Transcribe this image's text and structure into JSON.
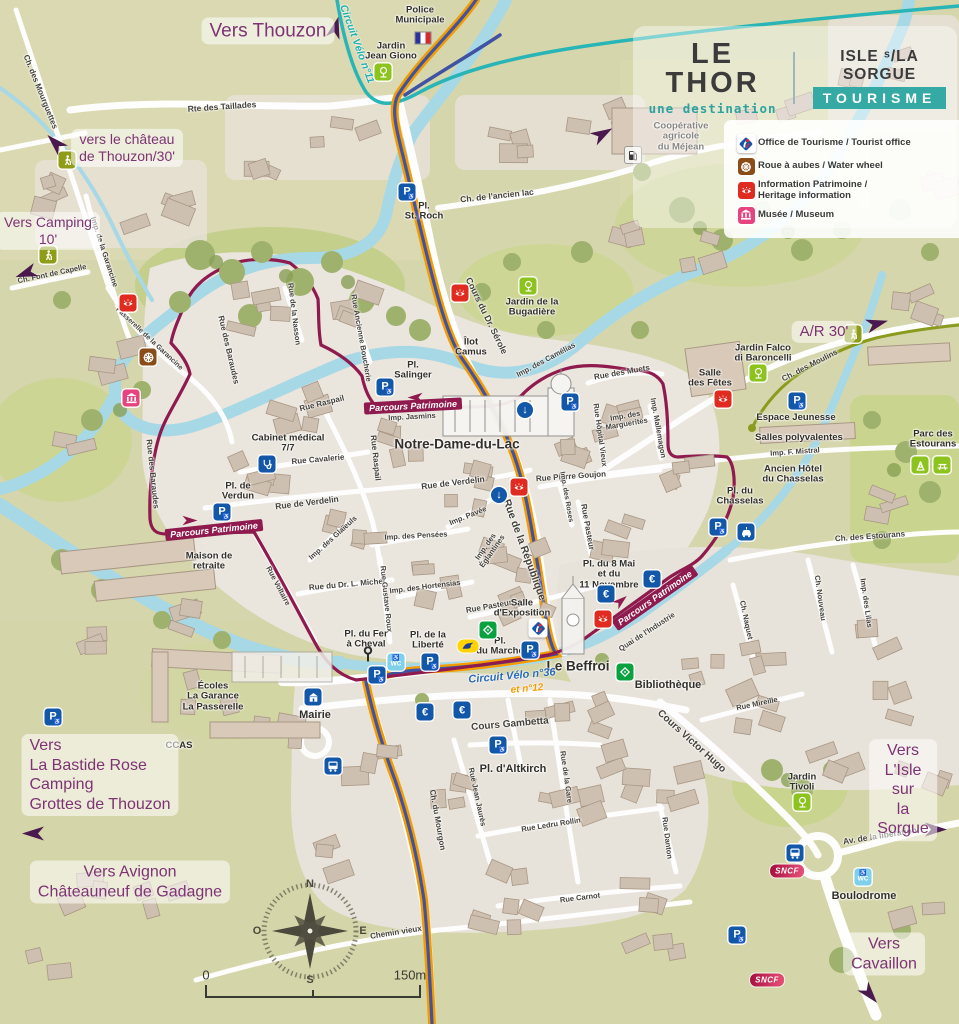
{
  "branding": {
    "title": "LE THOR",
    "subtitle": "une destination",
    "org_top": "ISLE ˢ/LA SORGUE",
    "org_bottom": "TOURISME"
  },
  "legend": {
    "items": [
      {
        "icon": "ot",
        "label": "Office de Tourisme / Tourist office"
      },
      {
        "icon": "wheel",
        "label": "Roue à aubes / Water wheel"
      },
      {
        "icon": "eye",
        "label": "Information Patrimoine /\nHeritage information"
      },
      {
        "icon": "museum",
        "label": "Musée / Museum"
      }
    ]
  },
  "compass": {
    "n": "N",
    "s": "S",
    "e": "E",
    "o": "O"
  },
  "scale": {
    "start": "0",
    "end": "150m"
  },
  "directions": [
    {
      "t": "Vers Thouzon",
      "x": 268,
      "y": 31,
      "s": 19
    },
    {
      "t": "vers le château\nde Thouzon/30'",
      "x": 127,
      "y": 148,
      "s": 14
    },
    {
      "t": "Vers Camping\n10'",
      "x": 48,
      "y": 231,
      "s": 14
    },
    {
      "t": "A/R 30'",
      "x": 824,
      "y": 332,
      "s": 15
    },
    {
      "t": "Vers\nLa Bastide Rose\nCamping\nGrottes de Thouzon",
      "x": 100,
      "y": 775,
      "s": 16,
      "align": "left"
    },
    {
      "t": "Vers Avignon\nChâteauneuf de Gadagne",
      "x": 130,
      "y": 882,
      "s": 16
    },
    {
      "t": "Vers\nL'Isle sur\nla Sorgue",
      "x": 903,
      "y": 790,
      "s": 16
    },
    {
      "t": "Vers Cavaillon",
      "x": 884,
      "y": 954,
      "s": 16
    }
  ],
  "route_labels": [
    {
      "t": "Circuit Vélo n°11",
      "x": 357,
      "y": 44,
      "r": 70,
      "c": "#1fb0b0",
      "s": 10.5
    },
    {
      "t": "Circuit Vélo n°36",
      "x": 512,
      "y": 676,
      "r": -5,
      "c": "#2a6bb5",
      "s": 11
    },
    {
      "t": "et n°12",
      "x": 527,
      "y": 689,
      "r": -5,
      "c": "#f39c00",
      "s": 10
    },
    {
      "t": "Parcours Patrimoine",
      "x": 214,
      "y": 530,
      "r": -6,
      "c": "#8f1a4d",
      "band": true
    },
    {
      "t": "Parcours Patrimoine",
      "x": 413,
      "y": 406,
      "r": -3,
      "c": "#8f1a4d",
      "band": true
    },
    {
      "t": "Parcours Patrimoine",
      "x": 655,
      "y": 598,
      "r": -35,
      "c": "#8f1a4d",
      "band": true
    }
  ],
  "places": [
    {
      "t": "Police\nMunicipale",
      "x": 420,
      "y": 16
    },
    {
      "t": "Jardin\nJean Giono",
      "x": 391,
      "y": 52
    },
    {
      "t": "Coopérative\nagricole\ndu Méjean",
      "x": 681,
      "y": 137
    },
    {
      "t": "Pl.\nSt. Roch",
      "x": 424,
      "y": 212
    },
    {
      "t": "Jardin de la\nBugadière",
      "x": 532,
      "y": 308
    },
    {
      "t": "Îlot\nCamus",
      "x": 471,
      "y": 348
    },
    {
      "t": "Pl.\nSalinger",
      "x": 413,
      "y": 371
    },
    {
      "t": "Notre-Dame-du-Lac",
      "x": 457,
      "y": 445,
      "s": 13.5
    },
    {
      "t": "Cabinet médical\n7/7",
      "x": 288,
      "y": 444
    },
    {
      "t": "Pl. de\nVerdun",
      "x": 238,
      "y": 492
    },
    {
      "t": "Maison de\nretraite",
      "x": 209,
      "y": 562
    },
    {
      "t": "Salle\ndes Fêtes",
      "x": 710,
      "y": 379
    },
    {
      "t": "Jardin Falco\ndi Baroncelli",
      "x": 763,
      "y": 354
    },
    {
      "t": "Espace Jeunesse",
      "x": 796,
      "y": 418
    },
    {
      "t": "Salles polyvalentes",
      "x": 799,
      "y": 438
    },
    {
      "t": "Ancien Hôtel\ndu Chasselas",
      "x": 793,
      "y": 475
    },
    {
      "t": "Parc des\nEstourans",
      "x": 933,
      "y": 440
    },
    {
      "t": "Pl. du\nChasselas",
      "x": 740,
      "y": 497
    },
    {
      "t": "Pl. du 8 Mai\net du\n11 Novembre",
      "x": 609,
      "y": 575
    },
    {
      "t": "Salle\nd'Exposition",
      "x": 522,
      "y": 609
    },
    {
      "t": "Pl. du Fer\nà Cheval",
      "x": 366,
      "y": 640
    },
    {
      "t": "Pl. de la\nLiberté",
      "x": 428,
      "y": 641
    },
    {
      "t": "Pl.\ndu Marché",
      "x": 500,
      "y": 647
    },
    {
      "t": "Le Beffroi",
      "x": 578,
      "y": 667,
      "s": 13.5
    },
    {
      "t": "Mairie",
      "x": 315,
      "y": 715,
      "s": 11
    },
    {
      "t": "Écoles\nLa Garance\nLa Passerelle",
      "x": 213,
      "y": 697
    },
    {
      "t": "CCAS",
      "x": 179,
      "y": 746
    },
    {
      "t": "Pl. d'Altkirch",
      "x": 513,
      "y": 769,
      "s": 11
    },
    {
      "t": "Bibliothèque",
      "x": 668,
      "y": 685,
      "s": 11
    },
    {
      "t": "Jardin\nTivoli",
      "x": 802,
      "y": 783
    },
    {
      "t": "Boulodrome",
      "x": 864,
      "y": 896,
      "s": 11
    }
  ],
  "streets": [
    {
      "t": "Ch. des Mourguettes",
      "x": 40,
      "y": 92,
      "r": 68,
      "s": 8
    },
    {
      "t": "Rte des Taillades",
      "x": 222,
      "y": 107,
      "r": -4,
      "s": 8.5
    },
    {
      "t": "Ch. de l'ancien lac",
      "x": 497,
      "y": 196,
      "r": -6,
      "s": 8.5
    },
    {
      "t": "Cours du Dr. Sérole",
      "x": 486,
      "y": 316,
      "r": 64,
      "s": 9
    },
    {
      "t": "Imp. de la Garancine",
      "x": 104,
      "y": 252,
      "r": 72,
      "s": 7.5
    },
    {
      "t": "Ch. Font de Capelle",
      "x": 52,
      "y": 274,
      "r": -12,
      "s": 7.5
    },
    {
      "t": "Passerelle de la Garancine",
      "x": 149,
      "y": 339,
      "r": 43,
      "s": 7
    },
    {
      "t": "Rue des Baraudes",
      "x": 228,
      "y": 350,
      "r": 77,
      "s": 8
    },
    {
      "t": "Rue des Baraudes",
      "x": 152,
      "y": 474,
      "r": 84,
      "s": 8
    },
    {
      "t": "Rue de la Nasson",
      "x": 294,
      "y": 314,
      "r": 83,
      "s": 7.5
    },
    {
      "t": "Rue Ancienne Boucherie",
      "x": 361,
      "y": 338,
      "r": 80,
      "s": 7.5
    },
    {
      "t": "Rue Raspail",
      "x": 322,
      "y": 404,
      "r": -14,
      "s": 8
    },
    {
      "t": "Rue Raspail",
      "x": 375,
      "y": 458,
      "r": 84,
      "s": 8
    },
    {
      "t": "Rue Cavalerie",
      "x": 318,
      "y": 460,
      "r": -5,
      "s": 8
    },
    {
      "t": "Imp. Jasmins",
      "x": 412,
      "y": 417,
      "r": -3,
      "s": 7.5
    },
    {
      "t": "Rue de Verdelin",
      "x": 307,
      "y": 503,
      "r": -7,
      "s": 8.5
    },
    {
      "t": "Rue de Verdelin",
      "x": 453,
      "y": 483,
      "r": -7,
      "s": 8.5
    },
    {
      "t": "Imp. des Glaïeuls",
      "x": 333,
      "y": 538,
      "r": -42,
      "s": 7.5
    },
    {
      "t": "Imp. Pavée",
      "x": 468,
      "y": 516,
      "r": -22,
      "s": 7.5
    },
    {
      "t": "Imp. des Pensées",
      "x": 416,
      "y": 536,
      "r": -3,
      "s": 7.5
    },
    {
      "t": "Imp. des\nÉglantines",
      "x": 489,
      "y": 549,
      "r": -55,
      "s": 7.5
    },
    {
      "t": "Imp. des Hortensias",
      "x": 425,
      "y": 587,
      "r": -7,
      "s": 7.5
    },
    {
      "t": "Rue du Dr. L. Michel",
      "x": 347,
      "y": 585,
      "r": -5,
      "s": 8
    },
    {
      "t": "Rue Gustave Roux",
      "x": 386,
      "y": 599,
      "r": 84,
      "s": 7.5
    },
    {
      "t": "Rue Voltaire",
      "x": 278,
      "y": 586,
      "r": 62,
      "s": 7.5
    },
    {
      "t": "Rue de la République",
      "x": 524,
      "y": 550,
      "r": 70,
      "s": 10.5
    },
    {
      "t": "Rue Pasteur",
      "x": 587,
      "y": 527,
      "r": 80,
      "s": 8
    },
    {
      "t": "Rue Pasteur",
      "x": 489,
      "y": 607,
      "r": -10,
      "s": 8
    },
    {
      "t": "Rue Pierre Goujon",
      "x": 571,
      "y": 477,
      "r": -4,
      "s": 8
    },
    {
      "t": "Imp. des Roses",
      "x": 566,
      "y": 497,
      "r": 80,
      "s": 7
    },
    {
      "t": "Rue Hôpital Vieux",
      "x": 600,
      "y": 435,
      "r": 82,
      "s": 7.5
    },
    {
      "t": "Imp. des\nMarguerites",
      "x": 626,
      "y": 420,
      "r": -10,
      "s": 7.5
    },
    {
      "t": "Rue des Muets",
      "x": 622,
      "y": 373,
      "r": -10,
      "s": 8
    },
    {
      "t": "Imp. Mallemagon",
      "x": 658,
      "y": 428,
      "r": 80,
      "s": 7.5
    },
    {
      "t": "Imp. des Camélias",
      "x": 546,
      "y": 360,
      "r": -28,
      "s": 7.5
    },
    {
      "t": "Ch. des Moulins",
      "x": 810,
      "y": 366,
      "r": -27,
      "s": 8
    },
    {
      "t": "Imp. F. Mistral",
      "x": 795,
      "y": 452,
      "r": -4,
      "s": 7.5
    },
    {
      "t": "Ch. des Estourans",
      "x": 870,
      "y": 537,
      "r": -4,
      "s": 8
    },
    {
      "t": "Ch. Naquet",
      "x": 746,
      "y": 620,
      "r": 78,
      "s": 7.5
    },
    {
      "t": "Ch. Nouveau",
      "x": 820,
      "y": 598,
      "r": 82,
      "s": 7.5
    },
    {
      "t": "Imp. des Lilas",
      "x": 866,
      "y": 603,
      "r": 82,
      "s": 7.5
    },
    {
      "t": "Quai de l'Industrie",
      "x": 647,
      "y": 632,
      "r": -33,
      "s": 7.5
    },
    {
      "t": "Rue Mireille",
      "x": 757,
      "y": 704,
      "r": -12,
      "s": 7.5
    },
    {
      "t": "Cours Victor Hugo",
      "x": 691,
      "y": 742,
      "r": 42,
      "s": 10
    },
    {
      "t": "Cours Gambetta",
      "x": 510,
      "y": 725,
      "r": -5,
      "s": 10
    },
    {
      "t": "Rue Jean Jaurès",
      "x": 477,
      "y": 797,
      "r": 78,
      "s": 7.5
    },
    {
      "t": "Rue de la Gare",
      "x": 566,
      "y": 777,
      "r": 82,
      "s": 7.5
    },
    {
      "t": "Rue Ledru Rollin",
      "x": 551,
      "y": 825,
      "r": -9,
      "s": 7.5
    },
    {
      "t": "Rue Carnot",
      "x": 580,
      "y": 898,
      "r": -7,
      "s": 7.5
    },
    {
      "t": "Rue Danton",
      "x": 667,
      "y": 838,
      "r": 83,
      "s": 7.5
    },
    {
      "t": "Ch. du Mourgon",
      "x": 437,
      "y": 820,
      "r": 80,
      "s": 8
    },
    {
      "t": "Chemin vieux",
      "x": 396,
      "y": 933,
      "r": -9,
      "s": 8
    },
    {
      "t": "Av. de la libération",
      "x": 880,
      "y": 836,
      "r": -9,
      "s": 8.5
    }
  ],
  "markers": [
    {
      "k": "parking",
      "x": 407,
      "y": 192
    },
    {
      "k": "parking",
      "x": 385,
      "y": 387
    },
    {
      "k": "parking",
      "x": 570,
      "y": 402
    },
    {
      "k": "parking",
      "x": 222,
      "y": 512
    },
    {
      "k": "parking",
      "x": 797,
      "y": 401
    },
    {
      "k": "parking",
      "x": 718,
      "y": 527
    },
    {
      "k": "parking",
      "x": 377,
      "y": 675
    },
    {
      "k": "parking",
      "x": 430,
      "y": 662
    },
    {
      "k": "parking",
      "x": 530,
      "y": 650
    },
    {
      "k": "parking",
      "x": 498,
      "y": 745
    },
    {
      "k": "parking",
      "x": 53,
      "y": 717
    },
    {
      "k": "parking",
      "x": 737,
      "y": 935
    },
    {
      "k": "euro",
      "x": 425,
      "y": 712
    },
    {
      "k": "euro",
      "x": 462,
      "y": 710
    },
    {
      "k": "euro",
      "x": 652,
      "y": 579
    },
    {
      "k": "euro",
      "x": 606,
      "y": 594
    },
    {
      "k": "wc",
      "x": 396,
      "y": 662
    },
    {
      "k": "wc",
      "x": 863,
      "y": 877
    },
    {
      "k": "bus",
      "x": 333,
      "y": 766
    },
    {
      "k": "bus",
      "x": 795,
      "y": 853
    },
    {
      "k": "sncf",
      "x": 787,
      "y": 871
    },
    {
      "k": "sncf",
      "x": 767,
      "y": 980
    },
    {
      "k": "eye",
      "x": 128,
      "y": 303
    },
    {
      "k": "eye",
      "x": 460,
      "y": 293
    },
    {
      "k": "eye",
      "x": 519,
      "y": 487
    },
    {
      "k": "eye",
      "x": 723,
      "y": 399
    },
    {
      "k": "eye",
      "x": 603,
      "y": 619
    },
    {
      "k": "wheel",
      "x": 148,
      "y": 357
    },
    {
      "k": "museum",
      "x": 131,
      "y": 398
    },
    {
      "k": "ot",
      "x": 538,
      "y": 628
    },
    {
      "k": "tree",
      "x": 383,
      "y": 72
    },
    {
      "k": "tree",
      "x": 528,
      "y": 286
    },
    {
      "k": "tree",
      "x": 758,
      "y": 373
    },
    {
      "k": "tree",
      "x": 802,
      "y": 802
    },
    {
      "k": "play",
      "x": 920,
      "y": 465
    },
    {
      "k": "picnic",
      "x": 942,
      "y": 465
    },
    {
      "k": "hiker",
      "x": 67,
      "y": 160
    },
    {
      "k": "hiker",
      "x": 48,
      "y": 255
    },
    {
      "k": "hiker",
      "x": 853,
      "y": 334
    },
    {
      "k": "oneway",
      "x": 525,
      "y": 410
    },
    {
      "k": "oneway",
      "x": 499,
      "y": 495
    },
    {
      "k": "medical",
      "x": 267,
      "y": 464
    },
    {
      "k": "ev",
      "x": 746,
      "y": 532
    },
    {
      "k": "fuel",
      "x": 633,
      "y": 155
    },
    {
      "k": "flag",
      "x": 423,
      "y": 38
    },
    {
      "k": "laposte",
      "x": 468,
      "y": 646
    },
    {
      "k": "mairie",
      "x": 313,
      "y": 697
    },
    {
      "k": "green",
      "x": 488,
      "y": 630
    },
    {
      "k": "green",
      "x": 625,
      "y": 672
    },
    {
      "k": "horseshoe",
      "x": 368,
      "y": 657
    }
  ],
  "arrows": [
    {
      "x": 338,
      "y": 28,
      "r": -75,
      "c": "purple"
    },
    {
      "x": 57,
      "y": 141,
      "r": -135,
      "c": "purple"
    },
    {
      "x": 25,
      "y": 271,
      "r": 160,
      "c": "purple"
    },
    {
      "x": 604,
      "y": 136,
      "r": -30,
      "c": "purple"
    },
    {
      "x": 878,
      "y": 326,
      "r": -15,
      "c": "purple"
    },
    {
      "x": 33,
      "y": 831,
      "r": 180,
      "c": "purple"
    },
    {
      "x": 936,
      "y": 832,
      "r": 0,
      "c": "purple"
    },
    {
      "x": 868,
      "y": 996,
      "r": 50,
      "c": "purple"
    },
    {
      "x": 190,
      "y": 522,
      "r": 0,
      "c": "maroon"
    },
    {
      "x": 415,
      "y": 396,
      "r": 180,
      "c": "maroon"
    },
    {
      "x": 622,
      "y": 602,
      "r": -40,
      "c": "maroon"
    }
  ]
}
